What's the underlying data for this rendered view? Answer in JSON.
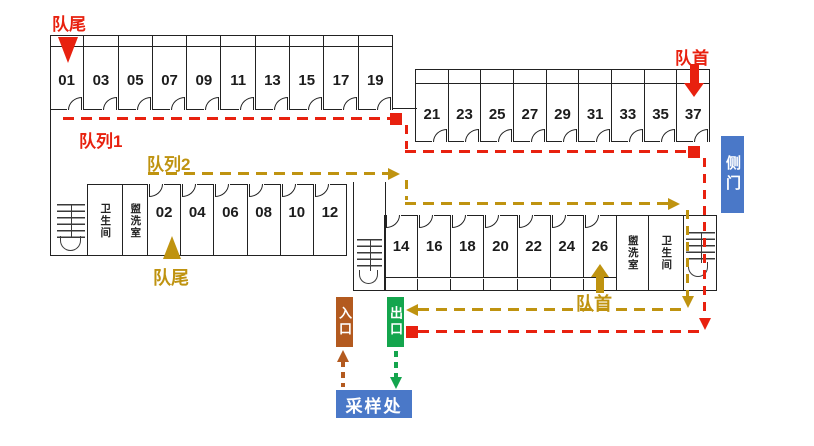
{
  "colors": {
    "wall": "#222222",
    "red": "#e8210f",
    "gold": "#bf9310",
    "blue": "#4a78c8",
    "green": "#14a54d",
    "brown": "#b35a1f"
  },
  "labels": {
    "queue1": "队列1",
    "queue2": "队列2",
    "queue_tail_red": "队尾",
    "queue_head_red": "队首",
    "queue_tail_gold": "队尾",
    "queue_head_gold": "队首",
    "side_door": "侧门",
    "entrance": "入口",
    "exit": "出口",
    "sampling_station": "采样处",
    "bathroom": "卫生间",
    "washroom": "盥洗室"
  },
  "rooms": {
    "row_top_left": [
      "01",
      "03",
      "05",
      "07",
      "09",
      "11",
      "13",
      "15",
      "17",
      "19"
    ],
    "row_top_right": [
      "21",
      "23",
      "25",
      "27",
      "29",
      "31",
      "33",
      "35",
      "37"
    ],
    "row_mid_left": [
      "02",
      "04",
      "06",
      "08",
      "10",
      "12"
    ],
    "row_bottom_right": [
      "14",
      "16",
      "18",
      "20",
      "22",
      "24",
      "26"
    ]
  }
}
